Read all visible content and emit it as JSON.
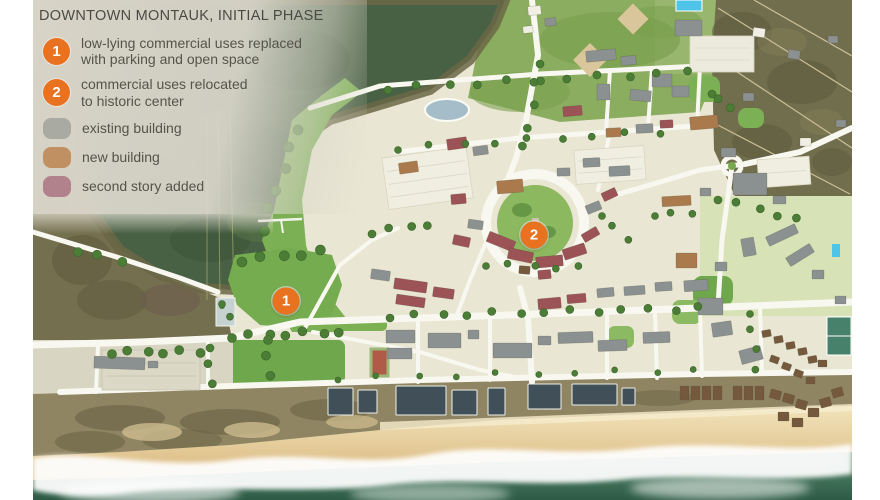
{
  "title": "DOWNTOWN MONTAUK, INITIAL PHASE",
  "palette": {
    "accent_orange": "#e8721f",
    "legend_bg": "#dbd8cc",
    "title_text": "#4b4a44",
    "body_text": "#55544b"
  },
  "legend": {
    "numbered": [
      {
        "num": "1",
        "lines": [
          "low-lying commercial uses replaced",
          "with parking and open space"
        ]
      },
      {
        "num": "2",
        "lines": [
          "commercial uses relocated",
          "to historic center"
        ]
      }
    ],
    "swatches": [
      {
        "label": "existing building",
        "color": "#a9aaa2"
      },
      {
        "label": "new building",
        "color": "#c08f62"
      },
      {
        "label": "second story added",
        "color": "#b2828c"
      }
    ]
  },
  "map": {
    "markers": [
      {
        "num": "1",
        "x": 286,
        "y": 301
      },
      {
        "num": "2",
        "x": 534,
        "y": 235
      }
    ],
    "building_colors": {
      "E": "#8b9091",
      "N": "#aa7a4d",
      "S": "#9c5355",
      "D": "#414f58",
      "B": "#75593c",
      "W": "#f1efe4"
    },
    "buildings": [
      [
        528,
        6,
        13,
        9,
        -6,
        "W"
      ],
      [
        545,
        18,
        11,
        8,
        -6,
        "E"
      ],
      [
        523,
        26,
        10,
        7,
        -6,
        "W"
      ],
      [
        586,
        50,
        30,
        11,
        -5,
        "E"
      ],
      [
        621,
        56,
        15,
        9,
        -5,
        "E"
      ],
      [
        597,
        84,
        13,
        16,
        0,
        "E"
      ],
      [
        630,
        90,
        21,
        11,
        5,
        "E"
      ],
      [
        672,
        86,
        17,
        11,
        0,
        "E"
      ],
      [
        563,
        106,
        19,
        10,
        -5,
        "S"
      ],
      [
        606,
        128,
        15,
        9,
        -3,
        "N"
      ],
      [
        636,
        124,
        17,
        9,
        -3,
        "E"
      ],
      [
        660,
        120,
        13,
        8,
        -3,
        "S"
      ],
      [
        652,
        74,
        20,
        13,
        0,
        "E"
      ],
      [
        690,
        116,
        28,
        13,
        -5,
        "N"
      ],
      [
        447,
        138,
        20,
        11,
        -8,
        "S"
      ],
      [
        473,
        146,
        15,
        9,
        -8,
        "E"
      ],
      [
        399,
        162,
        19,
        11,
        -8,
        "N"
      ],
      [
        497,
        180,
        26,
        13,
        -5,
        "N"
      ],
      [
        451,
        194,
        15,
        10,
        -5,
        "S"
      ],
      [
        557,
        168,
        13,
        8,
        -2,
        "E"
      ],
      [
        583,
        158,
        17,
        9,
        -3,
        "E"
      ],
      [
        609,
        166,
        21,
        10,
        -3,
        "E"
      ],
      [
        721,
        148,
        15,
        9,
        0,
        "E"
      ],
      [
        586,
        203,
        15,
        9,
        -22,
        "E"
      ],
      [
        602,
        190,
        15,
        9,
        -25,
        "S"
      ],
      [
        468,
        220,
        15,
        9,
        8,
        "E"
      ],
      [
        453,
        236,
        17,
        10,
        12,
        "S"
      ],
      [
        487,
        236,
        28,
        11,
        22,
        "S"
      ],
      [
        508,
        250,
        25,
        11,
        12,
        "S"
      ],
      [
        536,
        256,
        27,
        11,
        -5,
        "S"
      ],
      [
        563,
        246,
        23,
        11,
        -18,
        "S"
      ],
      [
        582,
        230,
        17,
        9,
        -30,
        "S"
      ],
      [
        519,
        266,
        11,
        8,
        5,
        "B"
      ],
      [
        538,
        270,
        13,
        9,
        -5,
        "S"
      ],
      [
        371,
        270,
        19,
        10,
        8,
        "E"
      ],
      [
        394,
        280,
        33,
        11,
        8,
        "S"
      ],
      [
        396,
        296,
        29,
        10,
        8,
        "S"
      ],
      [
        433,
        288,
        21,
        10,
        8,
        "S"
      ],
      [
        538,
        298,
        23,
        11,
        -5,
        "S"
      ],
      [
        567,
        294,
        19,
        9,
        -5,
        "S"
      ],
      [
        597,
        288,
        17,
        9,
        -5,
        "E"
      ],
      [
        624,
        286,
        21,
        9,
        -4,
        "E"
      ],
      [
        655,
        282,
        17,
        9,
        -4,
        "E"
      ],
      [
        684,
        280,
        24,
        11,
        -4,
        "E"
      ],
      [
        733,
        173,
        34,
        22,
        0,
        "E"
      ],
      [
        700,
        188,
        11,
        8,
        0,
        "E"
      ],
      [
        773,
        196,
        13,
        8,
        0,
        "E"
      ],
      [
        662,
        196,
        29,
        10,
        -3,
        "N"
      ],
      [
        676,
        253,
        21,
        15,
        0,
        "N"
      ],
      [
        766,
        230,
        32,
        10,
        -25,
        "E"
      ],
      [
        786,
        250,
        28,
        10,
        -32,
        "E"
      ],
      [
        742,
        238,
        13,
        18,
        -10,
        "E"
      ],
      [
        715,
        262,
        12,
        9,
        0,
        "E"
      ],
      [
        812,
        270,
        12,
        9,
        0,
        "E"
      ],
      [
        835,
        296,
        11,
        8,
        0,
        "E"
      ],
      [
        386,
        330,
        29,
        13,
        0,
        "E"
      ],
      [
        387,
        348,
        25,
        11,
        0,
        "E"
      ],
      [
        428,
        333,
        33,
        15,
        0,
        "E"
      ],
      [
        468,
        330,
        11,
        9,
        0,
        "E"
      ],
      [
        493,
        343,
        39,
        15,
        0,
        "E"
      ],
      [
        538,
        336,
        13,
        9,
        0,
        "E"
      ],
      [
        558,
        332,
        35,
        11,
        -2,
        "E"
      ],
      [
        598,
        340,
        29,
        11,
        -2,
        "E"
      ],
      [
        643,
        332,
        27,
        11,
        -2,
        "E"
      ],
      [
        698,
        298,
        25,
        17,
        0,
        "E"
      ],
      [
        712,
        322,
        20,
        14,
        -8,
        "E"
      ],
      [
        740,
        348,
        22,
        14,
        -15,
        "E"
      ],
      [
        94,
        357,
        51,
        12,
        2,
        "E"
      ],
      [
        148,
        361,
        10,
        7,
        0,
        "E"
      ],
      [
        762,
        330,
        9,
        7,
        -10,
        "B"
      ],
      [
        774,
        336,
        9,
        7,
        -10,
        "B"
      ],
      [
        786,
        342,
        9,
        7,
        -10,
        "B"
      ],
      [
        798,
        348,
        9,
        7,
        -10,
        "B"
      ],
      [
        808,
        356,
        9,
        7,
        -10,
        "B"
      ],
      [
        770,
        356,
        9,
        7,
        20,
        "B"
      ],
      [
        782,
        363,
        9,
        7,
        20,
        "B"
      ],
      [
        794,
        370,
        9,
        7,
        20,
        "B"
      ],
      [
        806,
        377,
        9,
        7,
        0,
        "B"
      ],
      [
        818,
        360,
        9,
        7,
        0,
        "B"
      ],
      [
        328,
        388,
        25,
        27,
        0,
        "D"
      ],
      [
        358,
        390,
        19,
        23,
        0,
        "D"
      ],
      [
        396,
        386,
        50,
        29,
        0,
        "D"
      ],
      [
        452,
        390,
        25,
        25,
        0,
        "D"
      ],
      [
        488,
        388,
        17,
        27,
        0,
        "D"
      ],
      [
        528,
        384,
        33,
        25,
        0,
        "D"
      ],
      [
        572,
        384,
        45,
        21,
        0,
        "D"
      ],
      [
        622,
        388,
        13,
        17,
        0,
        "D"
      ],
      [
        680,
        386,
        9,
        14,
        0,
        "B"
      ],
      [
        691,
        386,
        9,
        14,
        0,
        "B"
      ],
      [
        702,
        386,
        9,
        14,
        0,
        "B"
      ],
      [
        713,
        386,
        9,
        14,
        0,
        "B"
      ],
      [
        733,
        386,
        9,
        14,
        0,
        "B"
      ],
      [
        744,
        386,
        9,
        14,
        0,
        "B"
      ],
      [
        755,
        386,
        9,
        14,
        0,
        "B"
      ],
      [
        770,
        390,
        11,
        9,
        15,
        "B"
      ],
      [
        783,
        394,
        11,
        9,
        15,
        "B"
      ],
      [
        796,
        400,
        11,
        9,
        15,
        "B"
      ],
      [
        808,
        408,
        11,
        9,
        0,
        "B"
      ],
      [
        820,
        398,
        11,
        9,
        -15,
        "B"
      ],
      [
        832,
        388,
        11,
        9,
        -15,
        "B"
      ],
      [
        778,
        412,
        11,
        9,
        0,
        "B"
      ],
      [
        792,
        418,
        11,
        9,
        0,
        "B"
      ],
      [
        753,
        28,
        12,
        9,
        8,
        "W"
      ],
      [
        788,
        50,
        12,
        9,
        8,
        "E"
      ],
      [
        743,
        93,
        11,
        8,
        0,
        "E"
      ],
      [
        800,
        138,
        11,
        8,
        0,
        "W"
      ],
      [
        828,
        36,
        10,
        7,
        0,
        "E"
      ],
      [
        836,
        120,
        10,
        7,
        0,
        "E"
      ],
      [
        675,
        20,
        27,
        16,
        0,
        "E"
      ]
    ],
    "tree_rows": [
      [
        390,
        316,
        700,
        308,
        13,
        4
      ],
      [
        388,
        88,
        688,
        72,
        11,
        4
      ],
      [
        398,
        148,
        658,
        132,
        9,
        3.5
      ],
      [
        540,
        62,
        524,
        148,
        5,
        4
      ],
      [
        242,
        260,
        322,
        252,
        5,
        5
      ],
      [
        232,
        336,
        340,
        332,
        7,
        4.5
      ],
      [
        298,
        128,
        262,
        230,
        6,
        5
      ],
      [
        338,
        378,
        695,
        370,
        10,
        3
      ],
      [
        718,
        198,
        798,
        220,
        5,
        4
      ],
      [
        112,
        352,
        198,
        352,
        6,
        4.5
      ],
      [
        372,
        232,
        428,
        224,
        4,
        4
      ],
      [
        602,
        214,
        626,
        240,
        3,
        3.5
      ],
      [
        486,
        264,
        580,
        268,
        5,
        3.5
      ],
      [
        268,
        338,
        268,
        376,
        3,
        4.5
      ],
      [
        712,
        92,
        728,
        108,
        3,
        4
      ],
      [
        210,
        346,
        210,
        384,
        3,
        4
      ],
      [
        655,
        214,
        690,
        214,
        3,
        3.5
      ],
      [
        750,
        312,
        756,
        368,
        4,
        3.5
      ],
      [
        78,
        250,
        120,
        262,
        3,
        4.5
      ],
      [
        222,
        302,
        232,
        318,
        2,
        3.5
      ]
    ]
  }
}
